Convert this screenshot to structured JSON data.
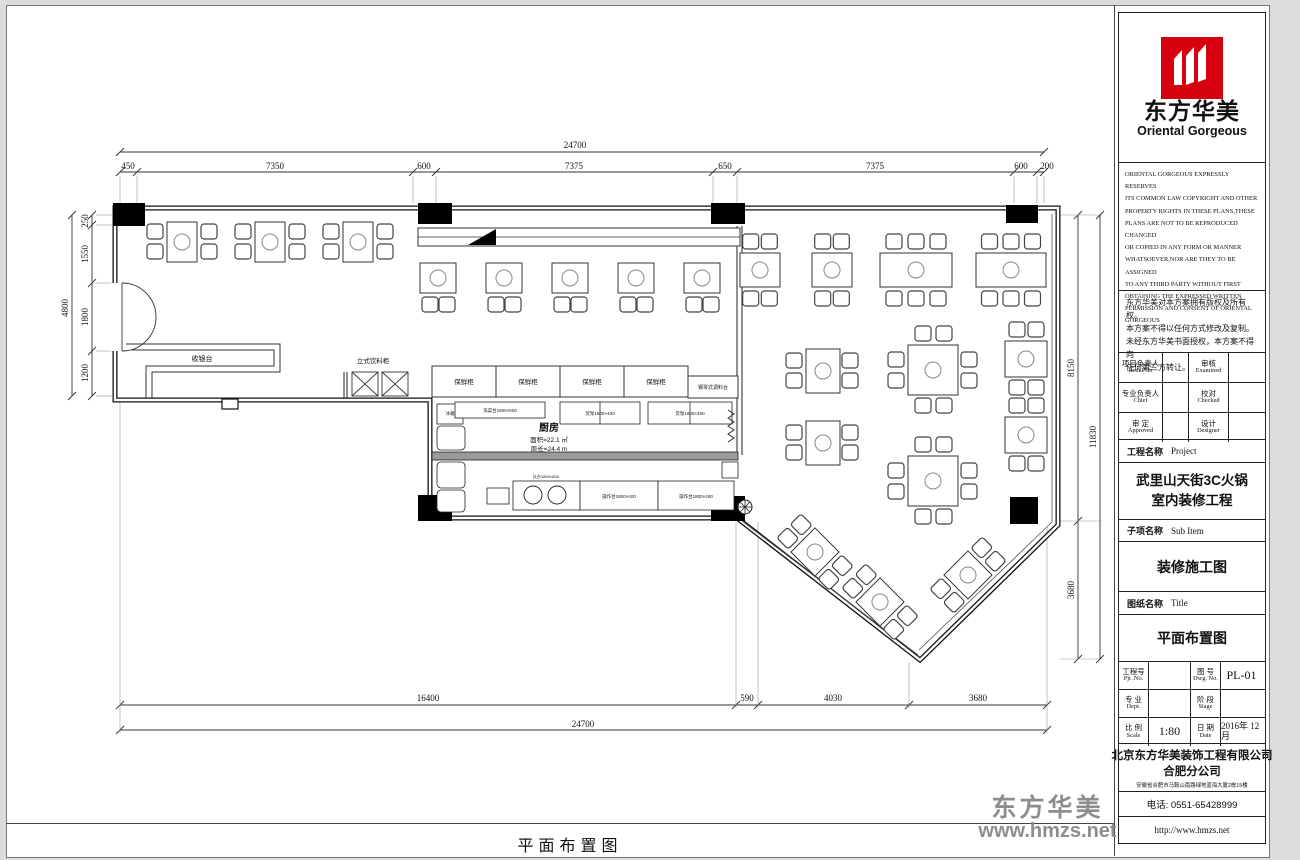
{
  "title_block": {
    "logo": {
      "cn": "东方华美",
      "en": "Oriental Gorgeous"
    },
    "copyright_en": [
      "ORIENTAL GORGEOUS EXPRESSLY RESERVES",
      "ITS COMMON LAW COPYRIGHT AND OTHER",
      "PROPERTY RIGHTS IN THESE PLANS,THESE",
      "PLANS ARE NOT TO BE REPRODUCED CHANGED",
      "OR COPIED IN ANY FORM OR MANNER",
      "WHATSOEVER,NOR ARE THEY TO BE ASSIGNED",
      "TO ANY THIRD PARTY WITHOUT FIRST",
      "OBTAINING THE EXPRESSED WRITTEN",
      "PERMISSION AND CONSENT OF ORIENTAL",
      "GORGEOUS"
    ],
    "copyright_cn": [
      "东方华美对本方案拥有版权及所有权。",
      "本方案不得以任何方式修改及复制。",
      "未经东方华美书面授权，本方案不得向",
      "任何第三方转让。"
    ],
    "approval": {
      "item_cn": "项目负责人",
      "item_en": "Item.Prin",
      "exam_cn": "审核",
      "exam_en": "Examined",
      "chief_cn": "专业负责人",
      "chief_en": "Chief",
      "check_cn": "校对",
      "check_en": "Checked",
      "appr_cn": "审 定",
      "appr_en": "Approved",
      "design_cn": "设计",
      "design_en": "Designer"
    },
    "project_label_cn": "工程名称",
    "project_label_en": "Project",
    "project_name": [
      "武里山天街3C火锅",
      "室内装修工程"
    ],
    "subitem_label_cn": "子项名称",
    "subitem_label_en": "Sub Item",
    "subitem_name": "装修施工图",
    "sheet_label_cn": "图纸名称",
    "sheet_label_en": "Title",
    "sheet_name": "平面布置图",
    "meta": {
      "pjt_cn": "工程号",
      "pjt_en": "Pjt .No.",
      "dwg_cn": "图 号",
      "dwg_en": "Dwg. No.",
      "dwg_no": "PL-01",
      "dept_cn": "专 业",
      "dept_en": "Dept.",
      "stage_cn": "阶 段",
      "stage_en": "Stage",
      "scale_cn": "比 例",
      "scale_en": "Scale",
      "scale_val": "1:80",
      "date_cn": "日 期",
      "date_en": "Date",
      "date_val": "2016年 12月"
    },
    "company": [
      "北京东方华美装饰工程有限公司",
      "合肥分公司"
    ],
    "address": "安徽省合肥市马鞍山南路绿地蓝海大厦2栋15楼",
    "phone": "电话: 0551-65428999",
    "website": "http://www.hmzs.net"
  },
  "plan": {
    "dims": {
      "top_total": "24700",
      "top": [
        "450",
        "7350",
        "600",
        "7375",
        "650",
        "7375",
        "600",
        "200"
      ],
      "left_total": "4800",
      "left": [
        "250",
        "1550",
        "1800",
        "1200"
      ],
      "right": [
        "8150",
        "3680"
      ],
      "right_total": "11830",
      "bottom": [
        "16400",
        "590",
        "4030",
        "3680"
      ],
      "bottom_total": "24700"
    },
    "labels": {
      "cashier": "收银台",
      "drink_cabinet": "立式饮料柜",
      "fresh_cabinet": "保鲜柜",
      "condiment_station": "钢琴式调料台",
      "kitchen": "厨房",
      "kitchen_area": "面积=22.1 ㎡",
      "kitchen_perimeter": "周长=24.4 m",
      "wash": "洗菜台1800×600",
      "shelf": "货架1800×400",
      "fridge": "冰箱",
      "stove": "灶台1800×800",
      "counter": "操作台1800×400"
    }
  },
  "footer": {
    "title": "平面布置图"
  },
  "watermark": {
    "cn": "东方华美",
    "site": "www.hmzs.net"
  }
}
